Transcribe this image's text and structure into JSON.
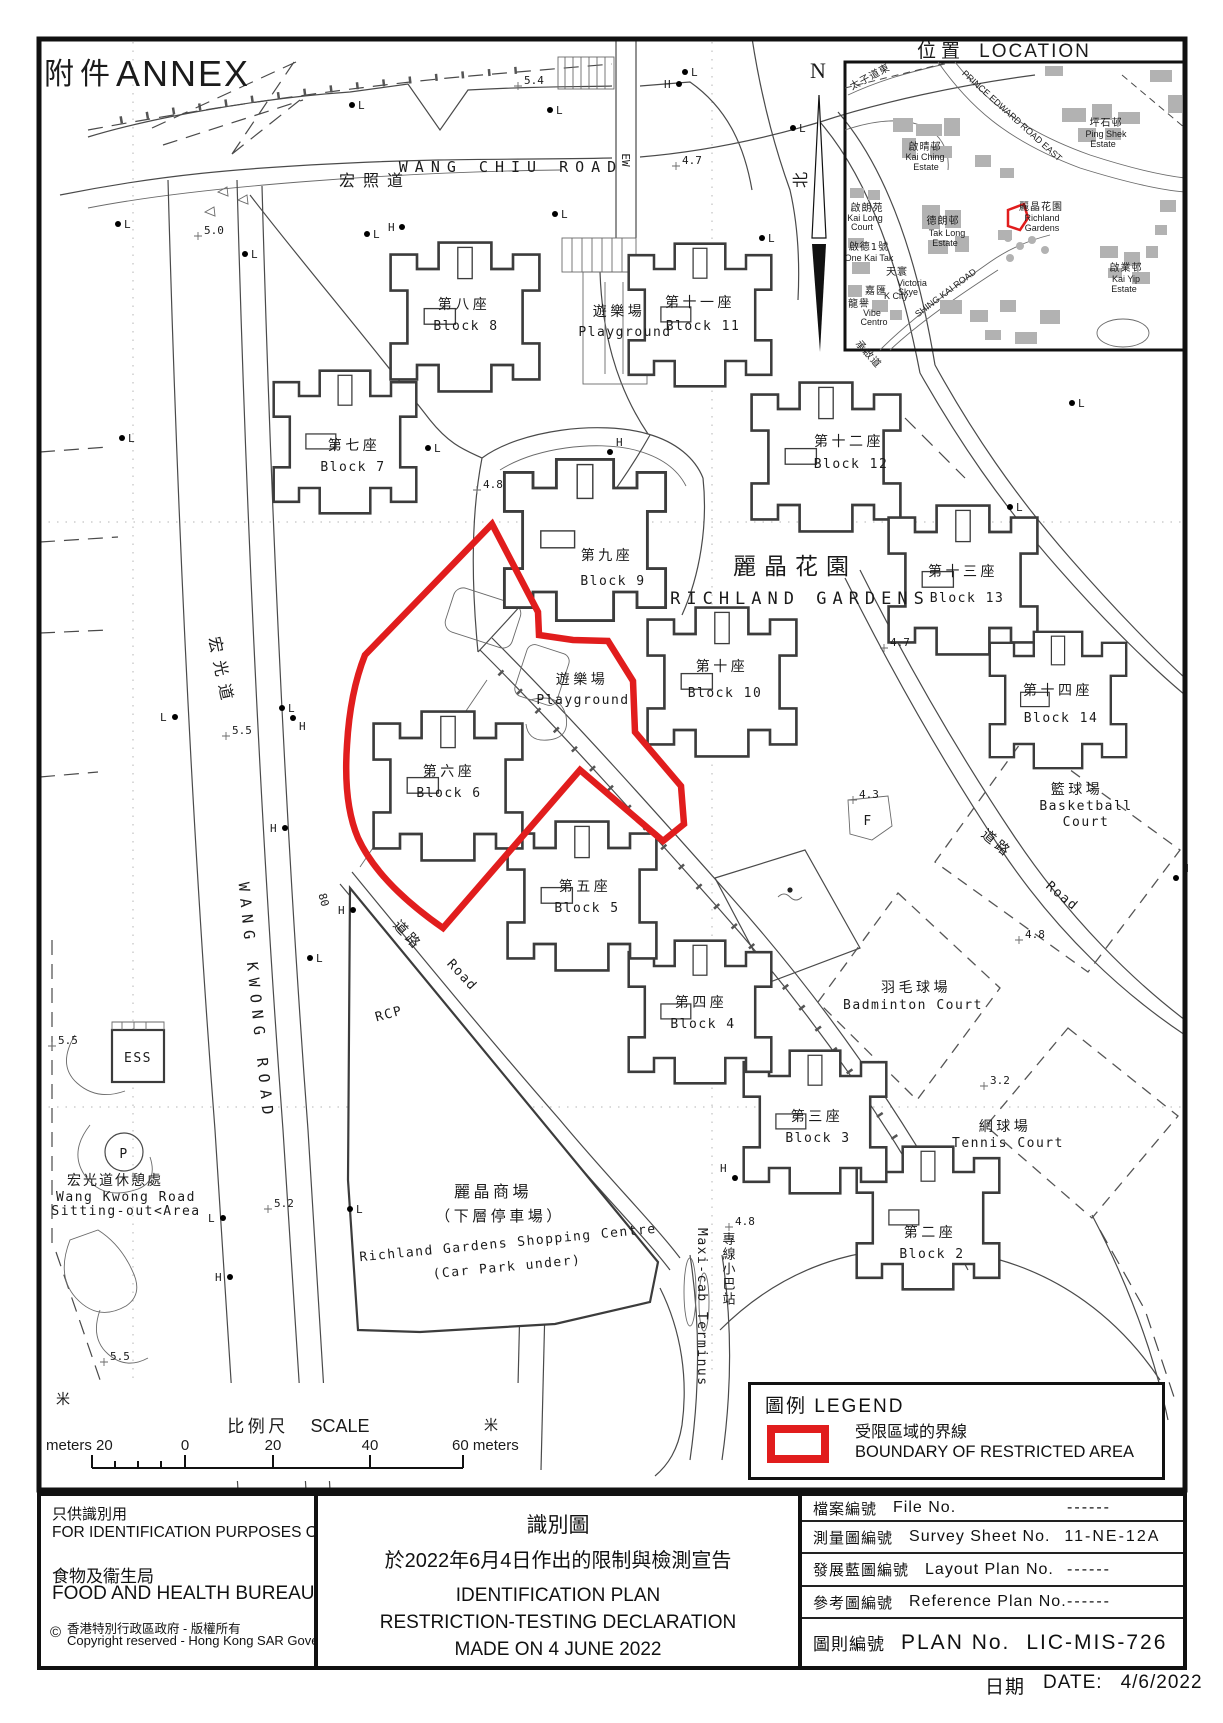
{
  "annex": {
    "zh": "附件",
    "en": "ANNEX"
  },
  "location": {
    "title_zh": "位置",
    "title_en": "LOCATION",
    "north_letter": "N",
    "north_zh": "北",
    "labels": {
      "prince_edward_zh": "太子道東",
      "prince_edward_en": "PRINCE EDWARD ROAD EAST",
      "kai_ching_zh": "啟晴邨",
      "kai_ching_en1": "Kai Ching",
      "kai_ching_en2": "Estate",
      "ping_shek_zh": "坪石邨",
      "ping_shek_en1": "Ping Shek",
      "ping_shek_en2": "Estate",
      "kai_long_zh": "啟朗苑",
      "kai_long_en1": "Kai Long",
      "kai_long_en2": "Court",
      "tak_long_zh": "德朗邨",
      "tak_long_en1": "Tak Long",
      "tak_long_en2": "Estate",
      "one_kai_tak_zh": "啟德1號",
      "one_kai_tak_en": "One Kai Tak",
      "tin_wan_zh": "天寰",
      "victoria1": "Victoria",
      "victoria2": "Skye",
      "k_city_zh": "嘉匯",
      "k_city_en": "K City",
      "vibe_zh": "龍譽",
      "vibe_en1": "Vibe",
      "vibe_en2": "Centro",
      "richland_zh": "麗晶花園",
      "richland_en1": "Richland",
      "richland_en2": "Gardens",
      "kai_yip_zh": "啟業邨",
      "kai_yip_en1": "Kai Yip",
      "kai_yip_en2": "Estate",
      "shing_kai": "SHING KAI ROAD",
      "shing_kai_zh": "承啟道"
    }
  },
  "map": {
    "roads": {
      "wang_chiu_zh": "宏照道",
      "wang_chiu_en": "WANG CHIU ROAD",
      "wang_kwong_zh": "宏光道",
      "wang_kwong_en": "WANG KWONG ROAD",
      "road_zh": "道路",
      "road_en": "Road",
      "ew": "EW",
      "eighty": "80",
      "rcp": "RCP"
    },
    "estate": {
      "zh": "麗晶花園",
      "en": "RICHLAND GARDENS"
    },
    "blocks": [
      {
        "zh": "第二座",
        "en": "Block 2"
      },
      {
        "zh": "第三座",
        "en": "Block 3"
      },
      {
        "zh": "第四座",
        "en": "Block 4"
      },
      {
        "zh": "第五座",
        "en": "Block 5"
      },
      {
        "zh": "第六座",
        "en": "Block 6"
      },
      {
        "zh": "第七座",
        "en": "Block 7"
      },
      {
        "zh": "第八座",
        "en": "Block 8"
      },
      {
        "zh": "第九座",
        "en": "Block 9"
      },
      {
        "zh": "第十座",
        "en": "Block 10"
      },
      {
        "zh": "第十一座",
        "en": "Block 11"
      },
      {
        "zh": "第十二座",
        "en": "Block 12"
      },
      {
        "zh": "第十三座",
        "en": "Block 13"
      },
      {
        "zh": "第十四座",
        "en": "Block 14"
      }
    ],
    "places": {
      "playground_zh": "遊樂場",
      "playground_en": "Playground",
      "basketball_zh": "籃球場",
      "basketball_en1": "Basketball",
      "basketball_en2": "Court",
      "badminton_zh": "羽毛球場",
      "badminton_en": "Badminton Court",
      "tennis_zh": "網球場",
      "tennis_en": "Tennis Court",
      "shopping_zh1": "麗晶商場",
      "shopping_zh2": "（下層停車場）",
      "shopping_en1": "Richland Gardens Shopping Centre",
      "shopping_en2": "(Car Park under)",
      "sitting_zh": "宏光道休憩處",
      "sitting_en1": "Wang Kwong Road",
      "sitting_en2": "Sitting-out<Area",
      "maxicab_zh": "專線小巴站",
      "maxicab_en": "Maxi-cab Terminus",
      "ess": "ESS",
      "p": "P",
      "f": "F"
    },
    "spot_heights": [
      "5.4",
      "4.7",
      "5.0",
      "4.8",
      "4.7",
      "5.5",
      "4.3",
      "4.8",
      "5.5",
      "3.2",
      "5.2",
      "4.8",
      "5.5"
    ],
    "marker_h": "H",
    "marker_l": "L"
  },
  "legend": {
    "title_zh": "圖例",
    "title_en": "LEGEND",
    "item_zh": "受限區域的界線",
    "item_en": "BOUNDARY OF RESTRICTED AREA",
    "boundary_color": "#e11d1d"
  },
  "scale": {
    "label_zh": "比例尺",
    "label_en": "SCALE",
    "m_zh_left": "米",
    "m_zh_right": "米",
    "left_label": "meters 20",
    "zero": "0",
    "twenty": "20",
    "forty": "40",
    "right_label": "60 meters"
  },
  "footer": {
    "id_zh": "只供識別用",
    "id_en": "FOR IDENTIFICATION PURPOSES ONLY",
    "bureau_zh": "食物及衞生局",
    "bureau_en": "FOOD AND HEALTH BUREAU",
    "copy_symbol": "©",
    "copy_zh": "香港特別行政區政府 - 版權所有",
    "copy_en": "Copyright reserved - Hong Kong SAR Government",
    "title_zh": "識別圖",
    "subtitle_zh": "於2022年6月4日作出的限制與檢測宣告",
    "title_en1": "IDENTIFICATION PLAN",
    "title_en2": "RESTRICTION-TESTING DECLARATION",
    "title_en3": "MADE ON 4 JUNE 2022",
    "rows": [
      {
        "zh": "檔案編號",
        "en": "File  No.",
        "value": "------"
      },
      {
        "zh": "測量圖編號",
        "en": "Survey  Sheet  No.",
        "value": "11-NE-12A"
      },
      {
        "zh": "發展藍圖編號",
        "en": "Layout  Plan  No.",
        "value": "------"
      },
      {
        "zh": "參考圖編號",
        "en": "Reference  Plan  No.",
        "value": "------"
      }
    ],
    "plan_row": {
      "zh": "圖則編號",
      "en": "PLAN  No.",
      "value": "LIC-MIS-726"
    },
    "date_zh": "日期",
    "date_en": "DATE:",
    "date_value": "4/6/2022"
  }
}
